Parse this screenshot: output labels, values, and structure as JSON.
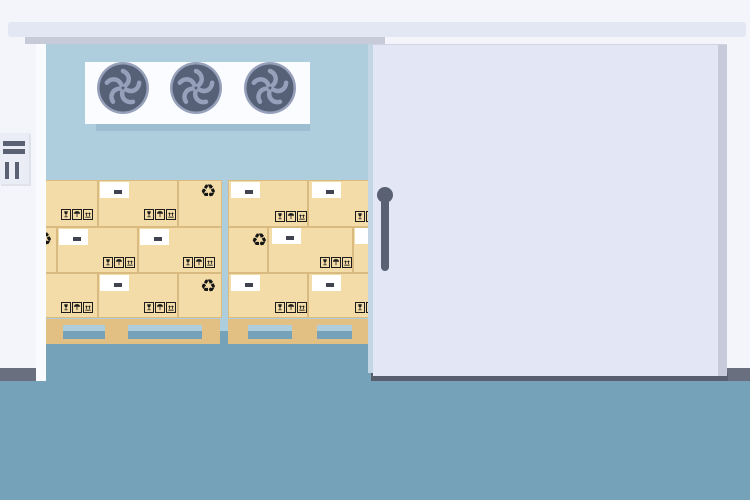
{
  "window": {
    "width": 750,
    "height": 500
  },
  "description": "Flat illustration of a cold storage warehouse room with its sliding insulated door half open, revealing stacked labeled cardboard boxes on wooden pallets and a three-fan cooling unit on the back wall. No text is rendered anywhere in the image.",
  "palette": {
    "outer_wall": "#f3f5fb",
    "rail": "#e3e7f3",
    "rail_shadow": "#c7cbd9",
    "interior_wall_blue": "#afcedd",
    "floor_blue": "#75a1b9",
    "fan_panel_white": "#fbfcff",
    "fan_panel_shadow": "#9cbed0",
    "fan_body_dark": "#566077",
    "fan_blade_light": "#97a0ba",
    "box_tan": "#f3dca7",
    "box_line": "#d9bb82",
    "pallet_tan": "#e2c084",
    "label_white": "#ffffff",
    "label_dash": "#3f4450",
    "icon_black": "#1c1c1c",
    "door": "#e3e7f5",
    "door_edge": "#c6cada",
    "door_bottom_shadow": "#585e6e",
    "baseboard": "#696f7f",
    "jamb_white": "#fafbfe",
    "control_panel": "#ebedf6",
    "handle_gray": "#5a6173"
  },
  "glyphs": {
    "recycle": "♻"
  },
  "label_spec": {
    "w": 29,
    "h": 16,
    "dash": {
      "w": 8,
      "h": 4,
      "left": 14,
      "top": 8
    }
  },
  "recycle_spec": {
    "w": 17,
    "h": 17
  },
  "handling_icon_names": [
    "fragile-glass-icon",
    "keep-dry-umbrella-icon",
    "this-way-up-icon"
  ],
  "scene": {
    "cooling_unit": {
      "fan_count": 3,
      "fan_cx": [
        123,
        196,
        270
      ],
      "fan_cy": 88,
      "fan_r": 26
    },
    "control_panel": {
      "h_bars": [
        {
          "x": 3,
          "y": 141,
          "w": 22,
          "h": 5
        },
        {
          "x": 3,
          "y": 149,
          "w": 22,
          "h": 5
        }
      ],
      "v_bars": [
        {
          "x": 5,
          "y": 162,
          "w": 4,
          "h": 17
        },
        {
          "x": 15,
          "y": 162,
          "w": 4,
          "h": 17
        }
      ]
    },
    "stacks": [
      {
        "name": "left-box-stack",
        "clip": {
          "x": 45,
          "y": 178,
          "w": 177,
          "h": 167
        },
        "boxes": [
          {
            "x": 45,
            "y": 180,
            "w": 53,
            "h": 47,
            "features": [
              {
                "kind": "icons",
                "right": 5,
                "bottom": 7
              }
            ]
          },
          {
            "x": 98,
            "y": 180,
            "w": 80,
            "h": 47,
            "features": [
              {
                "kind": "label",
                "left": 2,
                "top": 2
              },
              {
                "kind": "icons",
                "right": 2,
                "bottom": 7
              }
            ]
          },
          {
            "x": 178,
            "y": 180,
            "w": 44,
            "h": 47,
            "features": [
              {
                "kind": "recycle",
                "right": 5,
                "top": 3
              }
            ]
          },
          {
            "x": 12,
            "y": 227,
            "w": 45,
            "h": 46,
            "features": [
              {
                "kind": "recycle",
                "left": 24,
                "top": 4
              }
            ]
          },
          {
            "x": 57,
            "y": 227,
            "w": 81,
            "h": 46,
            "features": [
              {
                "kind": "label",
                "left": 2,
                "top": 2
              },
              {
                "kind": "icons",
                "right": 3,
                "bottom": 5
              }
            ]
          },
          {
            "x": 138,
            "y": 227,
            "w": 84,
            "h": 46,
            "features": [
              {
                "kind": "label",
                "left": 2,
                "top": 2
              },
              {
                "kind": "icons",
                "right": 7,
                "bottom": 5
              }
            ]
          },
          {
            "x": 45,
            "y": 273,
            "w": 53,
            "h": 45,
            "features": [
              {
                "kind": "icons",
                "right": 5,
                "bottom": 5
              }
            ]
          },
          {
            "x": 98,
            "y": 273,
            "w": 80,
            "h": 45,
            "features": [
              {
                "kind": "label",
                "left": 2,
                "top": 2
              },
              {
                "kind": "icons",
                "right": 2,
                "bottom": 5
              }
            ]
          },
          {
            "x": 178,
            "y": 273,
            "w": 44,
            "h": 45,
            "features": [
              {
                "kind": "recycle",
                "right": 5,
                "top": 5
              }
            ]
          }
        ],
        "pallet": {
          "top_plank": {
            "x": 45,
            "y": 319,
            "w": 175,
            "h": 6
          },
          "feet_y": 325,
          "feet_h": 14,
          "feet": [
            {
              "x": 45,
              "w": 18
            },
            {
              "x": 105,
              "w": 23
            },
            {
              "x": 202,
              "w": 18
            }
          ],
          "bottom_plank": {
            "x": 45,
            "y": 339,
            "w": 175,
            "h": 5
          }
        }
      },
      {
        "name": "right-box-stack",
        "clip": {
          "x": 228,
          "y": 178,
          "w": 140,
          "h": 167
        },
        "boxes": [
          {
            "x": 228,
            "y": 180,
            "w": 80,
            "h": 47,
            "features": [
              {
                "kind": "label",
                "left": 3,
                "top": 2
              },
              {
                "kind": "icons",
                "right": 1,
                "bottom": 5
              }
            ]
          },
          {
            "x": 308,
            "y": 180,
            "w": 80,
            "h": 47,
            "features": [
              {
                "kind": "label",
                "left": 4,
                "top": 2
              },
              {
                "kind": "icons",
                "right": 1,
                "bottom": 5
              }
            ]
          },
          {
            "x": 228,
            "y": 227,
            "w": 40,
            "h": 46,
            "features": [
              {
                "kind": "recycle",
                "left": 23,
                "top": 5
              }
            ]
          },
          {
            "x": 268,
            "y": 227,
            "w": 85,
            "h": 46,
            "features": [
              {
                "kind": "label",
                "left": 4,
                "top": 1
              },
              {
                "kind": "icons",
                "right": 1,
                "bottom": 5
              }
            ]
          },
          {
            "x": 353,
            "y": 227,
            "w": 80,
            "h": 46,
            "features": [
              {
                "kind": "label",
                "left": 2,
                "top": 1
              }
            ]
          },
          {
            "x": 228,
            "y": 273,
            "w": 80,
            "h": 45,
            "features": [
              {
                "kind": "label",
                "left": 3,
                "top": 2
              },
              {
                "kind": "icons",
                "right": 1,
                "bottom": 5
              }
            ]
          },
          {
            "x": 308,
            "y": 273,
            "w": 80,
            "h": 45,
            "features": [
              {
                "kind": "label",
                "left": 4,
                "top": 2
              },
              {
                "kind": "icons",
                "right": 1,
                "bottom": 5
              }
            ]
          }
        ],
        "pallet": {
          "top_plank": {
            "x": 228,
            "y": 319,
            "w": 145,
            "h": 6
          },
          "feet_y": 325,
          "feet_h": 14,
          "feet": [
            {
              "x": 228,
              "w": 20
            },
            {
              "x": 292,
              "w": 25
            },
            {
              "x": 352,
              "w": 18
            }
          ],
          "bottom_plank": {
            "x": 228,
            "y": 339,
            "w": 145,
            "h": 5
          }
        }
      }
    ]
  }
}
